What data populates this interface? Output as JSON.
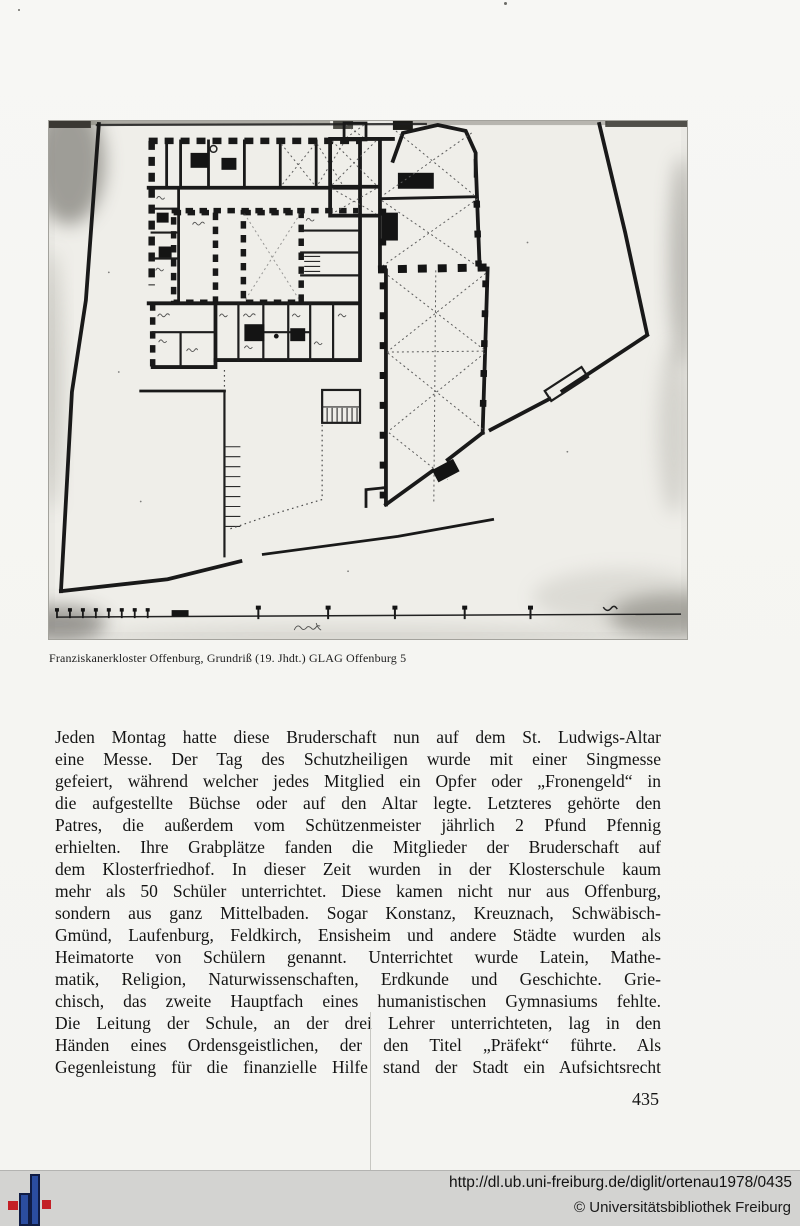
{
  "figure": {
    "caption": "Franziskanerkloster Offenburg, Grundriß (19. Jhdt.) GLAG Offenburg 5",
    "description": "Scanned photograph of a 19th-century hand-drawn floor plan of the Franciscan monastery in Offenburg with church, cloister courtyards, garden walls and a measuring scale at the bottom"
  },
  "body": {
    "lines": [
      "Jeden Montag hatte diese Bruderschaft nun auf dem St. Ludwigs-Altar",
      "eine Messe. Der Tag des Schutzheiligen wurde mit einer Singmesse",
      "gefeiert, während welcher jedes Mitglied ein Opfer oder „Fronengeld“ in",
      "die aufgestellte Büchse oder auf den Altar legte. Letzteres gehörte den",
      "Patres, die außerdem vom Schützenmeister jährlich 2 Pfund Pfennig",
      "erhielten. Ihre Grabplätze fanden die Mitglieder der Bruderschaft auf",
      "dem Klosterfriedhof. In dieser Zeit wurden in der Klosterschule kaum",
      "mehr als 50 Schüler unterrichtet. Diese kamen nicht nur aus Offenburg,",
      "sondern aus ganz Mittelbaden. Sogar Konstanz, Kreuznach, Schwäbisch-",
      "Gmünd, Laufenburg, Feldkirch, Ensisheim und andere Städte wurden als",
      "Heimatorte von Schülern genannt. Unterrichtet wurde Latein, Mathe-",
      "matik, Religion, Naturwissenschaften, Erdkunde und Geschichte. Grie-",
      "chisch, das zweite Hauptfach eines humanistischen Gymnasiums fehlte.",
      "Die Leitung der Schule, an der drei Lehrer unterrichteten, lag in den",
      "Händen eines Ordensgeistlichen, der den Titel „Präfekt“ führte. Als",
      "Gegenleistung für die finanzielle Hilfe stand der Stadt ein Aufsichtsrecht"
    ]
  },
  "page_number": "435",
  "footer": {
    "url": "http://dl.ub.uni-freiburg.de/diglit/ortenau1978/0435",
    "copyright": "© Universitätsbibliothek Freiburg"
  },
  "colors": {
    "logo_red": "#c32026",
    "logo_blue": "#2b4da0",
    "logo_blue_outline": "#101c44",
    "footer_background": "#d3d3d1",
    "photo_background": "#eae9e4"
  }
}
